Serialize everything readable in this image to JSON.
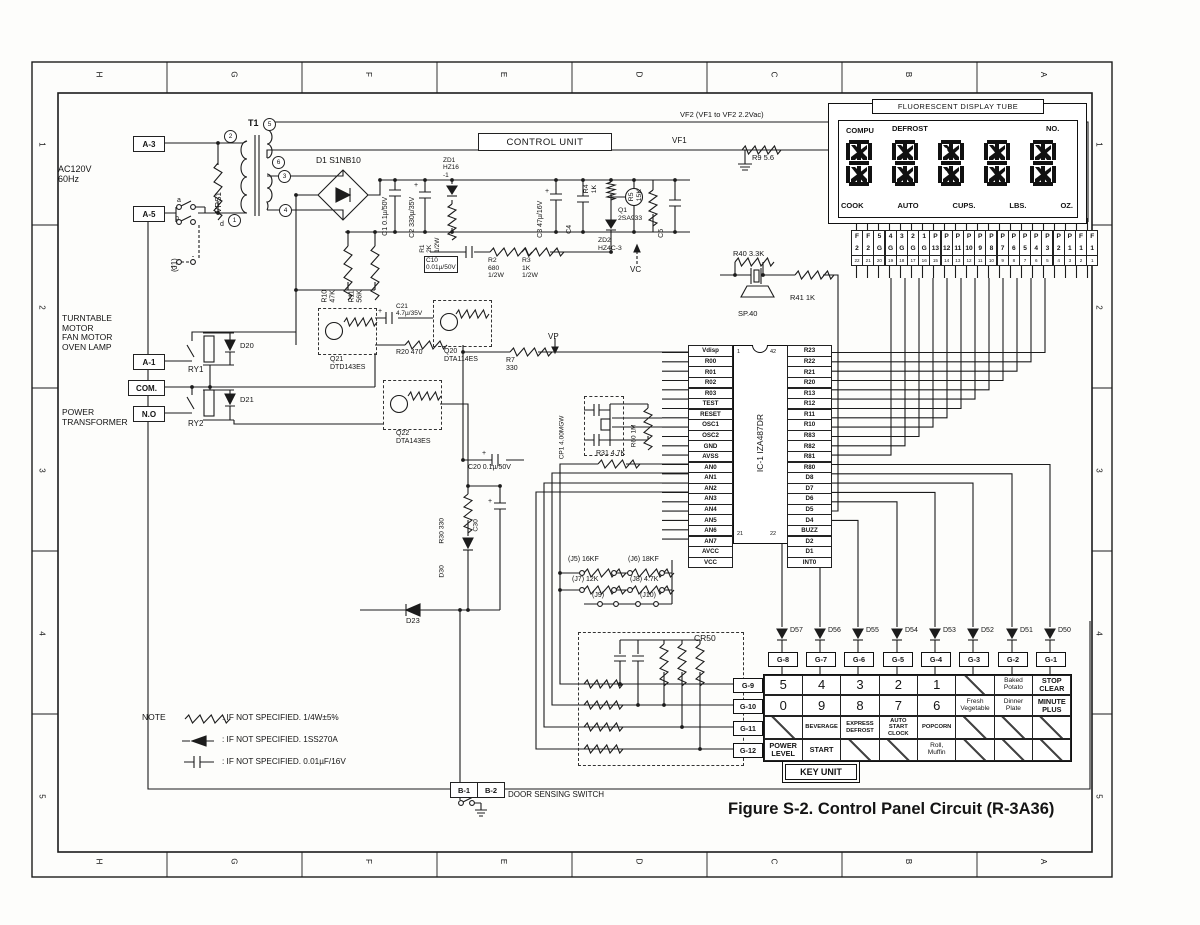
{
  "figure": {
    "caption": "Figure S-2. Control Panel Circuit (R-3A36)",
    "note_title": "NOTE",
    "note_items": [
      {
        "symbol": "resistor-symbol",
        "text": ":  IF NOT SPECIFIED. 1/4W±5%"
      },
      {
        "symbol": "diode-symbol",
        "text": ":  IF NOT SPECIFIED. 1SS270A"
      },
      {
        "symbol": "capacitor-symbol",
        "text": ":  IF NOT SPECIFIED. 0.01µF/16V"
      }
    ]
  },
  "border": {
    "cols": [
      "H",
      "G",
      "F",
      "E",
      "D",
      "C",
      "B",
      "A"
    ],
    "rows": [
      "1",
      "2",
      "3",
      "4",
      "5"
    ]
  },
  "sym": {
    "plus": "+"
  },
  "labels": {
    "ac": "AC120V\n60Hz",
    "a3": "A-3",
    "a5": "A-5",
    "a1": "A-1",
    "com": "COM.",
    "no": "N.O",
    "b1": "B-1",
    "b2": "B-2",
    "vrs1": "VRS1",
    "j1": "(J1)",
    "t1": "T1",
    "sw_a": "a",
    "sw_b": "b",
    "sw_c": "c",
    "sw_d": "d",
    "tpin2": "2",
    "tpin5": "5",
    "tpin6": "6",
    "tpin3": "3",
    "tpin4": "4",
    "tpin1": "1",
    "d1": "D1 S1NB10",
    "c1": "C1 0.1µ/50V",
    "c2": "C2 330µ/35V",
    "zd1": "ZD1\nHZ16\n-1",
    "r1": "R1\n2K\n1/2W",
    "r10": "R10\n47K",
    "r11": "R11\n56K",
    "c10": "C10\n0.01µ/50V",
    "r2": "R2\n680\n1/2W",
    "r3": "R3\n1K\n1/2W",
    "c3": "C3 47µ/16V",
    "c4": "C4",
    "r4": "R4\n1K",
    "q1": "Q1\n2SA933",
    "r5": "R5\n15K",
    "zd2": "ZD2\nHZ4C-3",
    "vc": "VC",
    "c5": "C5",
    "control_unit": "CONTROL UNIT",
    "vf2": "VF2 (VF1 to VF2 2.2Vac)",
    "vf1": "VF1",
    "r9": "R9 5.6",
    "r40": "R40 3.3K",
    "sp40": "SP.40",
    "r41": "R41 1K",
    "turntable": "TURNTABLE\nMOTOR\nFAN MOTOR\nOVEN LAMP",
    "power_transformer": "POWER\nTRANSFORMER",
    "ry1": "RY1",
    "ry2": "RY2",
    "d20": "D20",
    "d21": "D21",
    "q21": "Q21\nDTD143ES",
    "c21": "C21\n4.7µ/35V",
    "r20": "R20 470",
    "q20": "Q20\nDTA114ES",
    "q22": "Q22\nDTA143ES",
    "r7": "R7\n330",
    "vp": "VP",
    "cp1": "CP1 4.00MGW",
    "r60": "R60 1M",
    "r31": "R31 4.7K",
    "c20": "C20 0.1µ/50V",
    "r30": "R30 330",
    "d30": "D30",
    "c30": "C30",
    "d23": "D23",
    "j5": "(J5) 16KF",
    "j6": "(J6) 18KF",
    "j7": "(J7) 12K",
    "j8": "(J8) 4.7K",
    "j9": "(J9)",
    "j10": "(J10)",
    "cr50": "CR50",
    "door": "DOOR SENSING SWITCH"
  },
  "display": {
    "title": "FLUORESCENT DISPLAY TUBE",
    "top_labels": [
      "COMPU",
      "DEFROST",
      "NO."
    ],
    "bottom_labels": [
      "COOK",
      "AUTO",
      "CUPS.",
      "LBS.",
      "OZ."
    ],
    "pins": [
      {
        "t": "F",
        "b": "2",
        "n": "22"
      },
      {
        "t": "F",
        "b": "2",
        "n": "21"
      },
      {
        "t": "5",
        "b": "G",
        "n": "20"
      },
      {
        "t": "4",
        "b": "G",
        "n": "19"
      },
      {
        "t": "3",
        "b": "G",
        "n": "18"
      },
      {
        "t": "2",
        "b": "G",
        "n": "17"
      },
      {
        "t": "1",
        "b": "G",
        "n": "16"
      },
      {
        "t": "P",
        "b": "13",
        "n": "15"
      },
      {
        "t": "P",
        "b": "12",
        "n": "14"
      },
      {
        "t": "P",
        "b": "11",
        "n": "13"
      },
      {
        "t": "P",
        "b": "10",
        "n": "12"
      },
      {
        "t": "P",
        "b": "9",
        "n": "11"
      },
      {
        "t": "P",
        "b": "8",
        "n": "10"
      },
      {
        "t": "P",
        "b": "7",
        "n": "9"
      },
      {
        "t": "P",
        "b": "6",
        "n": "8"
      },
      {
        "t": "P",
        "b": "5",
        "n": "7"
      },
      {
        "t": "P",
        "b": "4",
        "n": "6"
      },
      {
        "t": "P",
        "b": "3",
        "n": "5"
      },
      {
        "t": "P",
        "b": "2",
        "n": "4"
      },
      {
        "t": "P",
        "b": "1",
        "n": "3"
      },
      {
        "t": "F",
        "b": "1",
        "n": "2"
      },
      {
        "t": "F",
        "b": "1",
        "n": "1"
      }
    ]
  },
  "ic": {
    "name": "IC-1 IZA487DR",
    "pin_tl": "1",
    "pin_bl": "21",
    "pin_tr": "42",
    "pin_br": "22",
    "left_pins": [
      "Vdisp",
      "R00",
      "R01",
      "R02",
      "R03",
      "TEST",
      "RESET",
      "OSC1",
      "OSC2",
      "GND",
      "AVSS",
      "AN0",
      "AN1",
      "AN2",
      "AN3",
      "AN4",
      "AN5",
      "AN6",
      "AN7",
      "AVCC",
      "VCC"
    ],
    "right_pins": [
      "R23",
      "R22",
      "R21",
      "R20",
      "R13",
      "R12",
      "R11",
      "R10",
      "R83",
      "R82",
      "R81",
      "R80",
      "D8",
      "D7",
      "D6",
      "D5",
      "D4",
      "BUZZ",
      "D2",
      "D1",
      "INT0"
    ]
  },
  "keyunit": {
    "title": "KEY UNIT",
    "diodes": [
      "D57",
      "D56",
      "D55",
      "D54",
      "D53",
      "D52",
      "D51",
      "D50"
    ],
    "cols": [
      "G-8",
      "G-7",
      "G-6",
      "G-5",
      "G-4",
      "G-3",
      "G-2",
      "G-1"
    ],
    "rows": [
      "G-9",
      "G-10",
      "G-11",
      "G-12"
    ],
    "keys": [
      {
        "label": "5",
        "cls": "num"
      },
      {
        "label": "4",
        "cls": "num"
      },
      {
        "label": "3",
        "cls": "num"
      },
      {
        "label": "2",
        "cls": "num"
      },
      {
        "label": "1",
        "cls": "num"
      },
      {
        "label": "",
        "cls": "diag"
      },
      {
        "label": "Baked\nPotato",
        "cls": "food"
      },
      {
        "label": "STOP\nCLEAR",
        "cls": "fn"
      },
      {
        "label": "0",
        "cls": "num"
      },
      {
        "label": "9",
        "cls": "num"
      },
      {
        "label": "8",
        "cls": "num"
      },
      {
        "label": "7",
        "cls": "num"
      },
      {
        "label": "6",
        "cls": "num"
      },
      {
        "label": "Fresh\nVegetable",
        "cls": "food"
      },
      {
        "label": "Dinner\nPlate",
        "cls": "food"
      },
      {
        "label": "MINUTE\nPLUS",
        "cls": "fn"
      },
      {
        "label": "",
        "cls": "diag"
      },
      {
        "label": "BEVERAGE",
        "cls": "small"
      },
      {
        "label": "EXPRESS\nDEFROST",
        "cls": "small"
      },
      {
        "label": "AUTO\nSTART\nCLOCK",
        "cls": "small"
      },
      {
        "label": "POPCORN",
        "cls": "small"
      },
      {
        "label": "",
        "cls": "diag"
      },
      {
        "label": "",
        "cls": "diag"
      },
      {
        "label": "",
        "cls": "diag"
      },
      {
        "label": "POWER\nLEVEL",
        "cls": "fn"
      },
      {
        "label": "START",
        "cls": "fn"
      },
      {
        "label": "",
        "cls": "diag"
      },
      {
        "label": "",
        "cls": "diag"
      },
      {
        "label": "Roll,\nMuffin",
        "cls": "food"
      },
      {
        "label": "",
        "cls": "diag"
      },
      {
        "label": "",
        "cls": "diag"
      },
      {
        "label": "",
        "cls": "diag"
      }
    ]
  }
}
